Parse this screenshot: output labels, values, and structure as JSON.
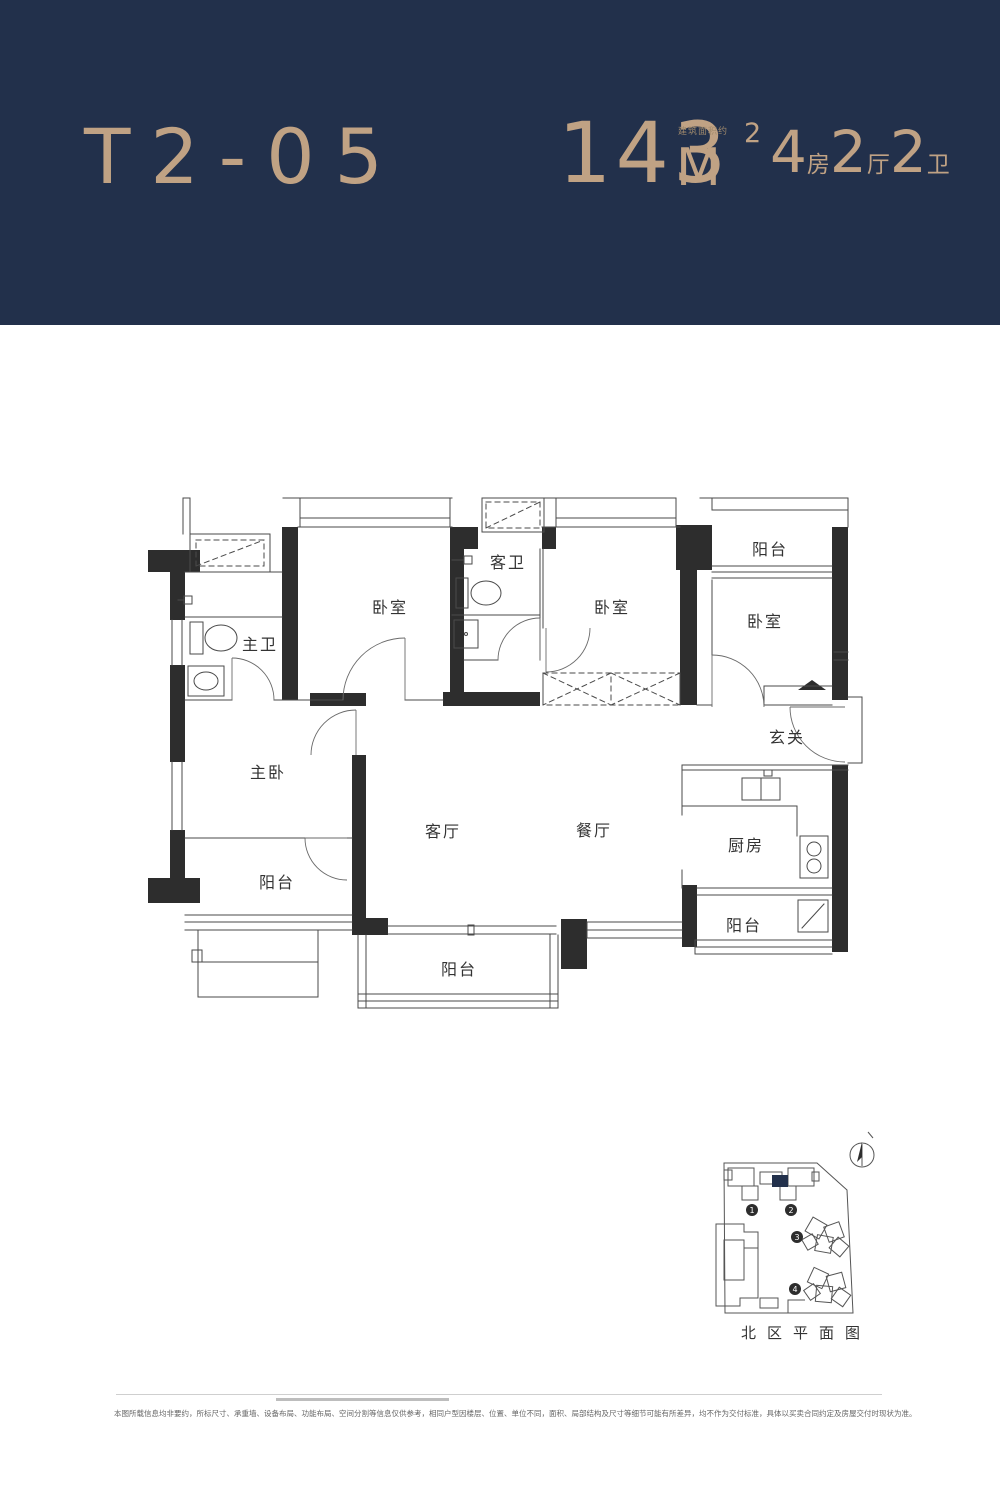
{
  "colors": {
    "header_bg": "#22304b",
    "accent": "#c0a284",
    "wall": "#2d2d2d",
    "line": "#4a4a4a"
  },
  "header": {
    "unit_code": "T2-05",
    "area": {
      "note": "建筑面积约",
      "value": "143",
      "unit": "M",
      "sup": "2"
    },
    "spec": [
      {
        "value": "4",
        "unit": "房"
      },
      {
        "value": "2",
        "unit": "厅"
      },
      {
        "value": "2",
        "unit": "卫"
      }
    ]
  },
  "floorplan": {
    "rooms": [
      {
        "id": "master-bath",
        "label": "主卫"
      },
      {
        "id": "bedroom-1",
        "label": "卧室"
      },
      {
        "id": "guest-bath",
        "label": "客卫"
      },
      {
        "id": "bedroom-2",
        "label": "卧室"
      },
      {
        "id": "balcony-top",
        "label": "阳台"
      },
      {
        "id": "bedroom-3",
        "label": "卧室"
      },
      {
        "id": "foyer",
        "label": "玄关"
      },
      {
        "id": "master-bedroom",
        "label": "主卧"
      },
      {
        "id": "living-room",
        "label": "客厅"
      },
      {
        "id": "dining-room",
        "label": "餐厅"
      },
      {
        "id": "kitchen",
        "label": "厨房"
      },
      {
        "id": "balcony-left",
        "label": "阳台"
      },
      {
        "id": "balcony-bottom",
        "label": "阳台"
      },
      {
        "id": "balcony-kitchen",
        "label": "阳台"
      }
    ]
  },
  "siteplan": {
    "caption": "北区平面图",
    "buildings": [
      "1",
      "2",
      "3",
      "4"
    ]
  },
  "footer": {
    "disclaimer": "本图所载信息均非要约，所标尺寸、承重墙、设备布局、功能布局、空间分割等信息仅供参考，相同户型因楼层、位置、单位不同，面积、局部结构及尺寸等细节可能有所差异，均不作为交付标准，具体以买卖合同约定及房屋交付时现状为准。"
  }
}
